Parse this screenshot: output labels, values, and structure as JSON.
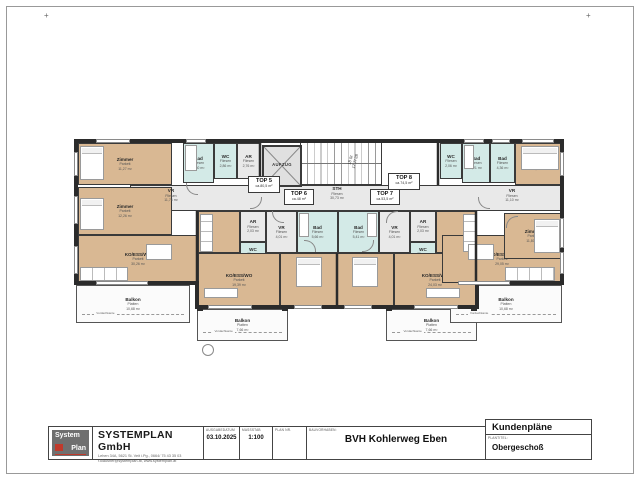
{
  "sheet": {
    "corner_mark": "+"
  },
  "apartments": [
    {
      "id": "top5",
      "label": "TOP 5",
      "area": "ca.80,5 m²"
    },
    {
      "id": "top6",
      "label": "TOP 6",
      "area": "ca.48 m²"
    },
    {
      "id": "top7",
      "label": "TOP 7",
      "area": "ca.53,5 m²"
    },
    {
      "id": "top8",
      "label": "TOP 8",
      "area": "ca.74,5 m²"
    }
  ],
  "rooms": {
    "zimmer_5a": {
      "name": "Zimmer",
      "floor": "Parkett",
      "area": "11,27 m²"
    },
    "zimmer_5b": {
      "name": "Zimmer",
      "floor": "Parkett",
      "area": "12,26 m²"
    },
    "bad_5": {
      "name": "Bad",
      "floor": "Fliesen",
      "area": "7,60 m²"
    },
    "wc_5": {
      "name": "WC",
      "floor": "Fliesen",
      "area": "2,86 m²"
    },
    "ar_5": {
      "name": "AR",
      "floor": "Fliesen",
      "area": "2,76 m²"
    },
    "vr_5": {
      "name": "VR",
      "floor": "Fliesen",
      "area": "11,76 m²"
    },
    "ko_5": {
      "name": "KO/ESS/WO",
      "floor": "Parkett",
      "area": "30,26 m²"
    },
    "balkon_5": {
      "name": "Balkon",
      "floor": "Platten",
      "area": "10,68 m²"
    },
    "ar_6": {
      "name": "AR",
      "floor": "Fliesen",
      "area": "2,03 m²"
    },
    "wc_6": {
      "name": "WC",
      "floor": "Fliesen",
      "area": "1,48 m²"
    },
    "vr_6": {
      "name": "VR",
      "floor": "Fliesen",
      "area": "4,01 m²"
    },
    "bad_6": {
      "name": "Bad",
      "floor": "Fliesen",
      "area": "5,66 m²"
    },
    "ko_6": {
      "name": "KO/ESS/WO",
      "floor": "Parkett",
      "area": "19,39 m²"
    },
    "zimmer_6": {
      "name": "Zimmer",
      "floor": "Parkett",
      "area": "11,88 m²"
    },
    "balkon_6": {
      "name": "Balkon",
      "floor": "Platten",
      "area": "7,66 m²"
    },
    "bad_7": {
      "name": "Bad",
      "floor": "Fliesen",
      "area": "5,41 m²"
    },
    "vr_7": {
      "name": "VR",
      "floor": "Fliesen",
      "area": "4,01 m²"
    },
    "ar_7": {
      "name": "AR",
      "floor": "Fliesen",
      "area": "2,03 m²"
    },
    "wc_7": {
      "name": "WC",
      "floor": "Fliesen",
      "area": "1,48 m²"
    },
    "zimmer_7": {
      "name": "Zimmer",
      "floor": "Parkett",
      "area": "11,88 m²"
    },
    "ko_7": {
      "name": "KO/ESS/WO",
      "floor": "Parkett",
      "area": "24,03 m²"
    },
    "balkon_7": {
      "name": "Balkon",
      "floor": "Platten",
      "area": "7,66 m²"
    },
    "wc_8": {
      "name": "WC",
      "floor": "Fliesen",
      "area": "2,06 m²"
    },
    "bad_8a": {
      "name": "Bad",
      "floor": "Fliesen",
      "area": "4,21 m²"
    },
    "bad_8b": {
      "name": "Bad",
      "floor": "Fliesen",
      "area": "4,36 m²"
    },
    "zimmer_8a": {
      "name": "Zimmer",
      "floor": "Parkett",
      "area": "12,01 m²"
    },
    "vr_8": {
      "name": "VR",
      "floor": "Fliesen",
      "area": "11,10 m²"
    },
    "zimmer_8b": {
      "name": "Zimmer",
      "floor": "Parkett",
      "area": "11,80 m²"
    },
    "ko_8": {
      "name": "KO/ESS/WO",
      "floor": "Parkett",
      "area": "29,05 m²"
    },
    "balkon_8": {
      "name": "Balkon",
      "floor": "Platten",
      "area": "10,68 m²"
    },
    "sth": {
      "name": "STH",
      "floor": "Fliesen",
      "area": "30,73 m²"
    }
  },
  "elevator": {
    "label": "AUFZUG"
  },
  "stairs": {
    "note_line1": "18 St",
    "note_line2": "17,7/ 28"
  },
  "labels": {
    "vordachkante": "Vordachkante"
  },
  "title_block": {
    "logo_line1": "System",
    "logo_line2": "Plan",
    "company_name": "SYSTEMPLAN GmbH",
    "company_address1": "Lehen 34A, 5621 St. Veit i.Pg., 0664/ 75 43 35 03",
    "company_address2": "r.klausner@systemplan.at, www.systemplan.at",
    "fields": [
      {
        "label": "AUSGABEDATUM",
        "value": "03.10.2025"
      },
      {
        "label": "MASSSTAB",
        "value": "1:100"
      },
      {
        "label": "PLAN Nr.",
        "value": ""
      },
      {
        "label": "BAUVORHABEN:",
        "value": "BVH Kohlerweg Eben"
      }
    ],
    "doc_title": "Kundenpläne",
    "plan_title_label": "PLANTITEL:",
    "plan_title": "Obergeschoß"
  },
  "colors": {
    "parkett": "#d9b893",
    "fliesen": "#d3eae7",
    "corridor": "#e9e9e9",
    "wall": "#2b2b2b",
    "balcony": "#fbfbfb",
    "logo_red": "#c0392b",
    "logo_gray": "#6f6f6f"
  }
}
